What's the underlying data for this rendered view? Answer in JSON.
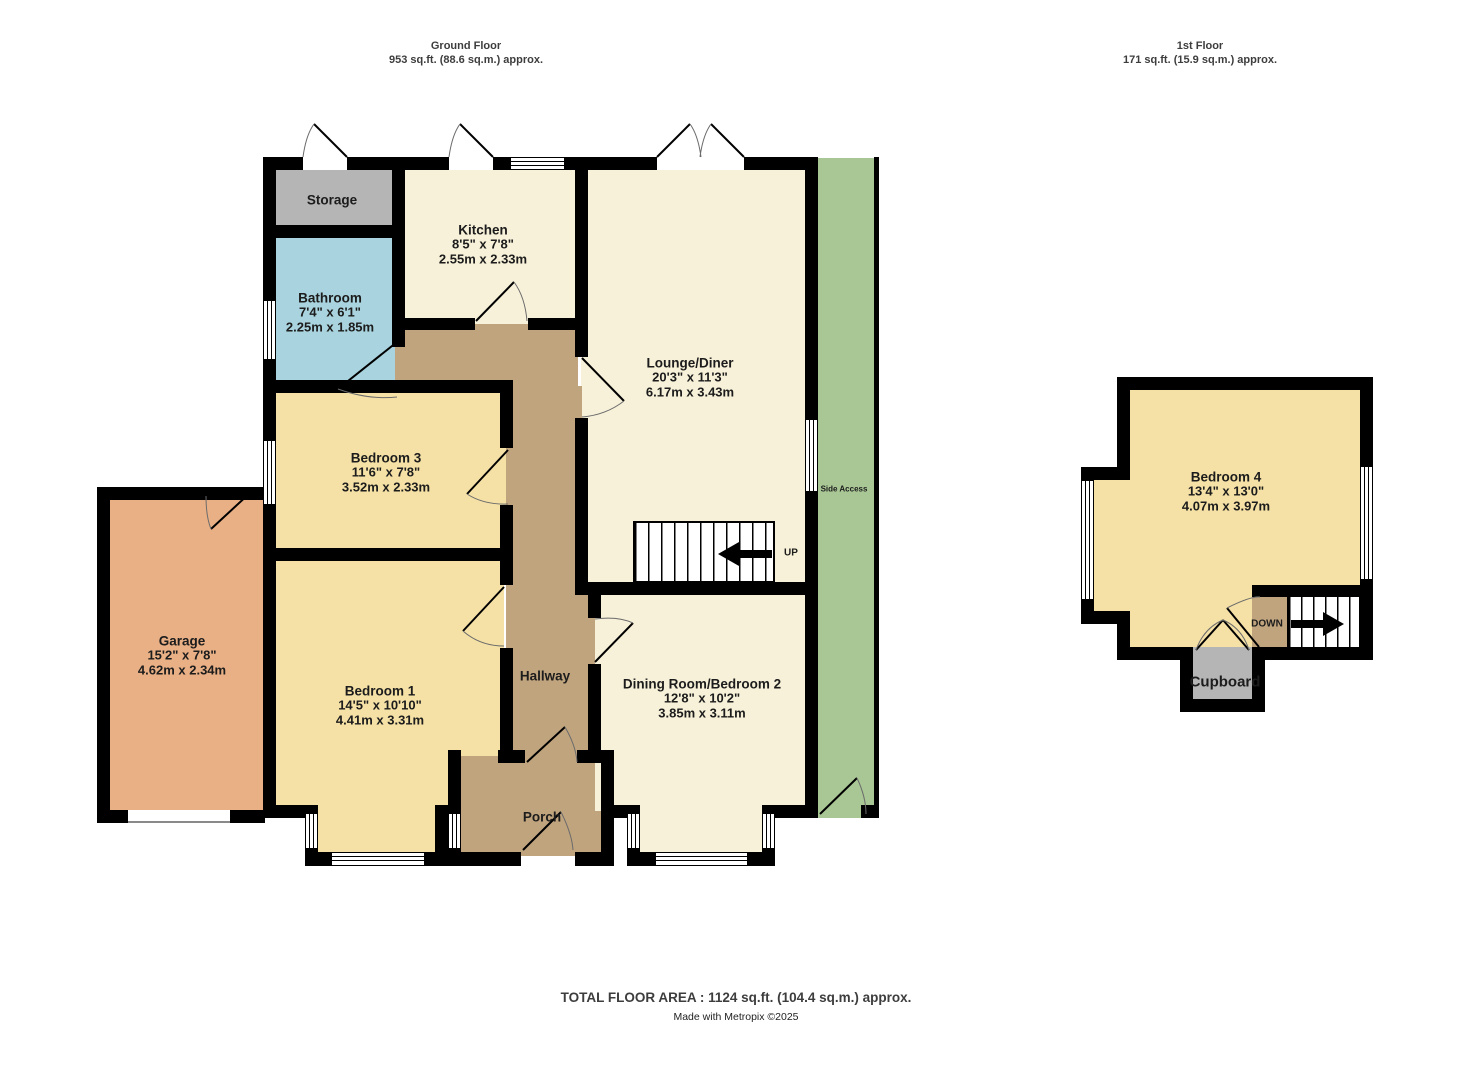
{
  "headers": {
    "ground": {
      "title": "Ground Floor",
      "area": "953 sq.ft. (88.6 sq.m.) approx."
    },
    "first": {
      "title": "1st Floor",
      "area": "171 sq.ft. (15.9 sq.m.) approx."
    }
  },
  "rooms": {
    "storage": {
      "name": "Storage"
    },
    "kitchen": {
      "name": "Kitchen",
      "imperial": "8'5\"  x 7'8\"",
      "metric": "2.55m  x 2.33m"
    },
    "bathroom": {
      "name": "Bathroom",
      "imperial": "7'4\"  x 6'1\"",
      "metric": "2.25m  x 1.85m"
    },
    "lounge_diner": {
      "name": "Lounge/Diner",
      "imperial": "20'3\"  x 11'3\"",
      "metric": "6.17m  x 3.43m"
    },
    "bedroom3": {
      "name": "Bedroom 3",
      "imperial": "11'6\"  x 7'8\"",
      "metric": "3.52m  x 2.33m"
    },
    "garage": {
      "name": "Garage",
      "imperial": "15'2\"  x 7'8\"",
      "metric": "4.62m  x 2.34m"
    },
    "bedroom1": {
      "name": "Bedroom 1",
      "imperial": "14'5\"  x 10'10\"",
      "metric": "4.41m  x 3.31m"
    },
    "hallway": {
      "name": "Hallway"
    },
    "dining": {
      "name": "Dining Room/Bedroom 2",
      "imperial": "12'8\"  x 10'2\"",
      "metric": "3.85m  x 3.11m"
    },
    "porch": {
      "name": "Porch"
    },
    "side_access": {
      "name": "Side Access"
    },
    "bedroom4": {
      "name": "Bedroom 4",
      "imperial": "13'4\"  x 13'0\"",
      "metric": "4.07m  x 3.97m"
    },
    "cupboard": {
      "name": "Cupboard"
    }
  },
  "stairs": {
    "up": "UP",
    "down": "DOWN"
  },
  "footer": {
    "total": "TOTAL FLOOR AREA : 1124 sq.ft. (104.4 sq.m.) approx.",
    "credit": "Made with Metropix ©2025"
  },
  "colors": {
    "wall": "#000000",
    "cream": "#f7f1d9",
    "yellow": "#f5e1a6",
    "blue": "#a9d3de",
    "gray": "#b5b5b5",
    "orange": "#e9b086",
    "tan": "#c0a47e",
    "green": "#a9c795"
  }
}
